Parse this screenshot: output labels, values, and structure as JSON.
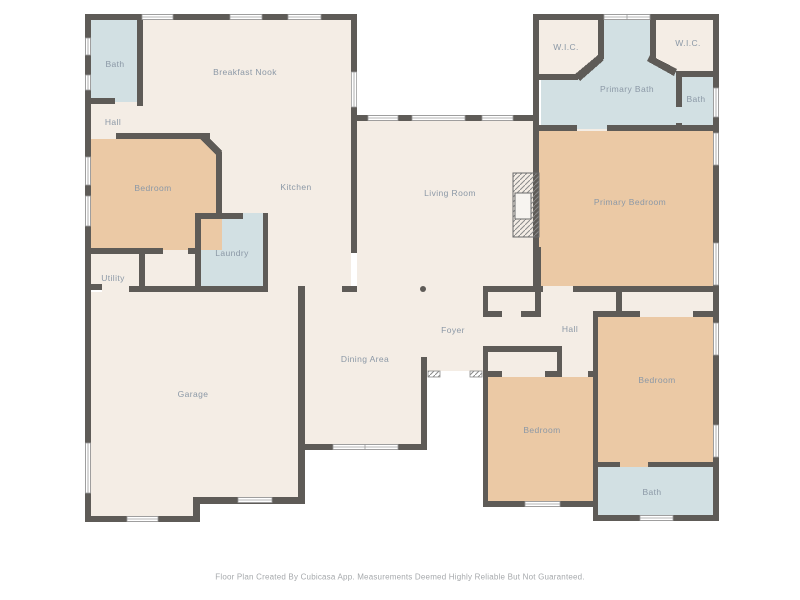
{
  "palette": {
    "wall": "#5e5b57",
    "floor_default": "#f4ede5",
    "floor_bedroom": "#ebc9a5",
    "floor_bath": "#d2e0e3",
    "label_text": "#8b98a6",
    "footer_text": "#a6a9ac",
    "window_outline": "#9b9b9b"
  },
  "rooms": [
    {
      "id": "bath-top-left",
      "label": "Bath",
      "x": 115,
      "y": 64
    },
    {
      "id": "breakfast-nook",
      "label": "Breakfast Nook",
      "x": 245,
      "y": 72
    },
    {
      "id": "hall-top-left",
      "label": "Hall",
      "x": 113,
      "y": 122
    },
    {
      "id": "bedroom-top-left",
      "label": "Bedroom",
      "x": 153,
      "y": 188
    },
    {
      "id": "kitchen",
      "label": "Kitchen",
      "x": 296,
      "y": 187
    },
    {
      "id": "laundry",
      "label": "Laundry",
      "x": 232,
      "y": 253
    },
    {
      "id": "utility",
      "label": "Utility",
      "x": 113,
      "y": 278
    },
    {
      "id": "living-room",
      "label": "Living Room",
      "x": 450,
      "y": 193
    },
    {
      "id": "wic-left",
      "label": "W.I.C.",
      "x": 566,
      "y": 47
    },
    {
      "id": "primary-bath",
      "label": "Primary Bath",
      "x": 627,
      "y": 89
    },
    {
      "id": "wic-right",
      "label": "W.I.C.",
      "x": 688,
      "y": 43
    },
    {
      "id": "bath-top-right",
      "label": "Bath",
      "x": 696,
      "y": 99
    },
    {
      "id": "primary-bedroom",
      "label": "Primary Bedroom",
      "x": 630,
      "y": 202
    },
    {
      "id": "garage",
      "label": "Garage",
      "x": 193,
      "y": 394
    },
    {
      "id": "dining-area",
      "label": "Dining Area",
      "x": 365,
      "y": 359
    },
    {
      "id": "foyer",
      "label": "Foyer",
      "x": 453,
      "y": 330
    },
    {
      "id": "hall-center",
      "label": "Hall",
      "x": 570,
      "y": 329
    },
    {
      "id": "bedroom-right",
      "label": "Bedroom",
      "x": 657,
      "y": 380
    },
    {
      "id": "bedroom-bottom",
      "label": "Bedroom",
      "x": 542,
      "y": 430
    },
    {
      "id": "bath-bottom-right",
      "label": "Bath",
      "x": 652,
      "y": 492
    }
  ],
  "footer": {
    "text": "Floor Plan Created By Cubicasa App. Measurements Deemed Highly Reliable But Not Guaranteed."
  }
}
